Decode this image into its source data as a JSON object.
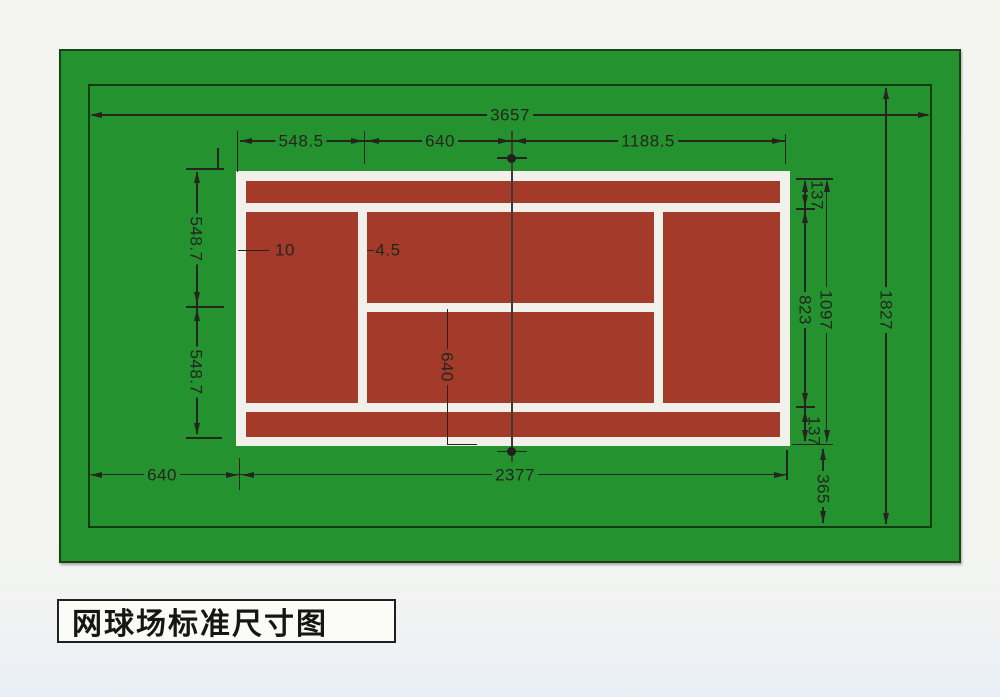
{
  "diagram": {
    "title": "网球场标准尺寸图",
    "type": "tennis-court-standard-dimensions-plan",
    "dims": {
      "total_length": "3657",
      "total_width": "1827",
      "court_length": "2377",
      "runback": "640",
      "backcourt_depth": "548.5",
      "service_line_to_net": "640",
      "net_to_baseline": "1188.5",
      "alley_width_top": "137",
      "alley_width_bottom": "137",
      "singles_width": "823",
      "doubles_width": "1097",
      "side_space": "365",
      "half_width_upper": "548.7",
      "half_width_lower": "548.7",
      "baseline_line_width": "10",
      "inner_line_width": "4.5",
      "center_service_leader": "640"
    },
    "colors": {
      "surround_green": "#259230",
      "court_red": "#a43a2a",
      "line_white": "#f2f0ea",
      "ink": "#24251f"
    }
  }
}
